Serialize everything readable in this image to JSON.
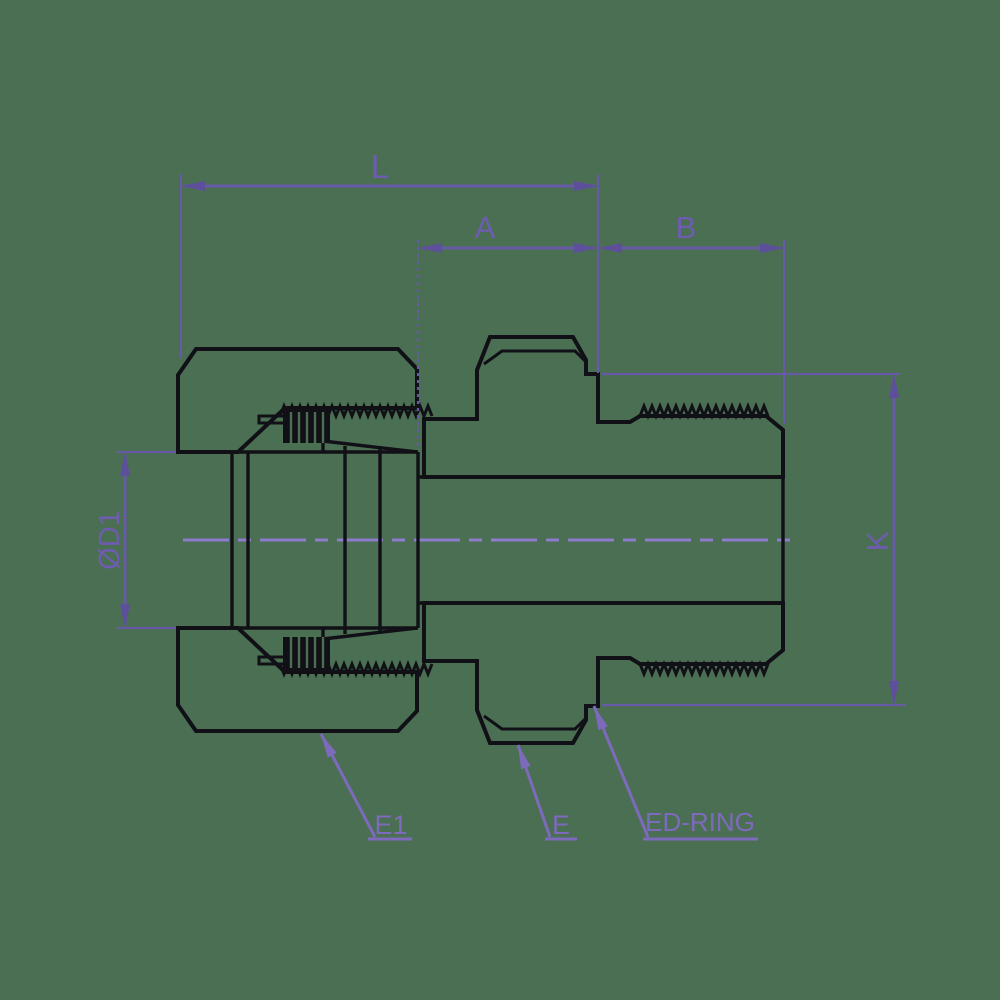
{
  "drawing_kind": "technical section drawing of a threaded tube fitting with swivel nut",
  "colors": {
    "background": "#4a6f52",
    "line": "#101016",
    "dimension": "#675aa6",
    "leader": "#7e6abc",
    "centerline": "#8d7bcc",
    "text": "#6e5cb0"
  },
  "dimensions": {
    "L": "L",
    "A": "A",
    "B": "B",
    "K": "K",
    "D1": "ØD1"
  },
  "leaders": {
    "E1": "E1",
    "E": "E",
    "ED_RING": "ED-RING"
  }
}
